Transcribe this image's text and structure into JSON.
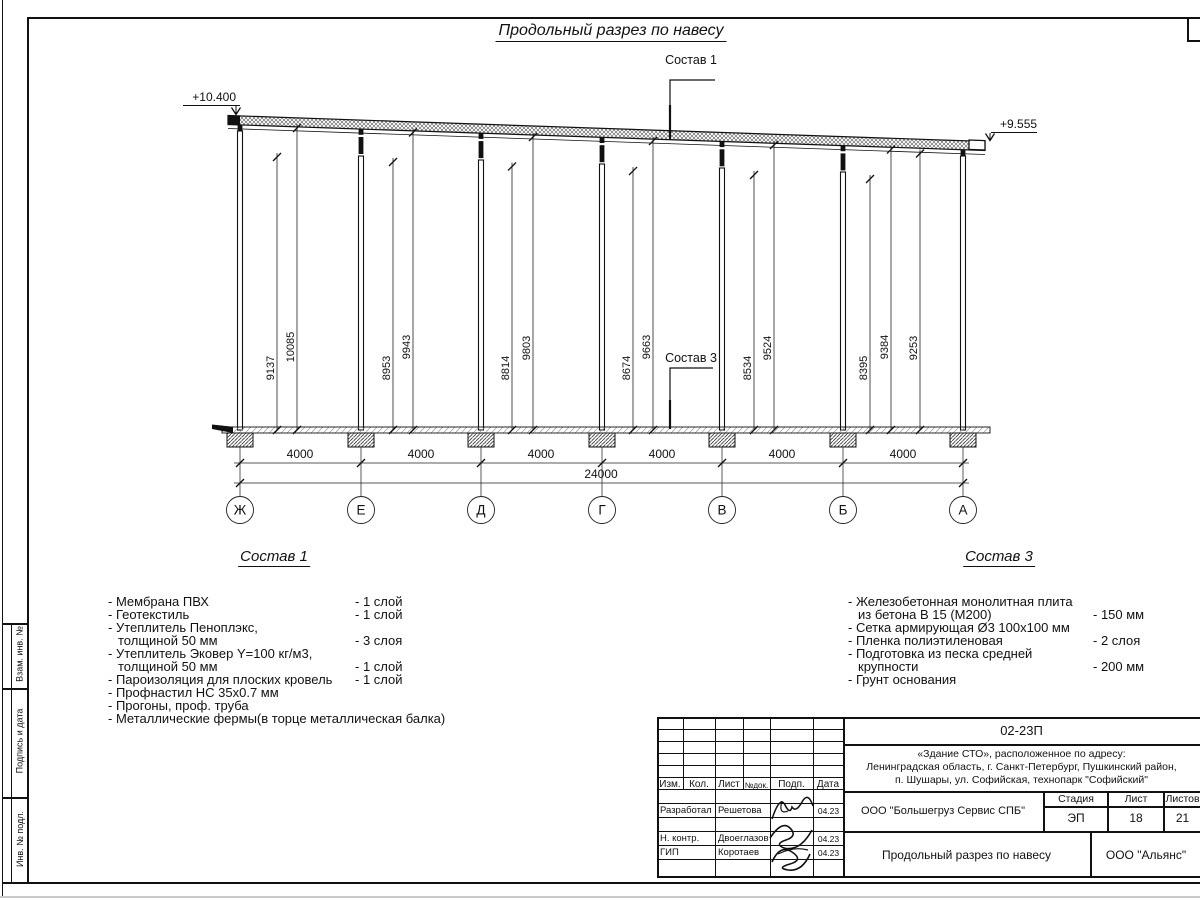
{
  "drawing": {
    "title": "Продольный разрез по навесу",
    "elevation_left": "+10.400",
    "elevation_right": "+9.555",
    "leader1": "Состав 1",
    "leader3": "Состав 3",
    "axis_labels": [
      "Ж",
      "Е",
      "Д",
      "Г",
      "В",
      "Б",
      "А"
    ],
    "bay_dim": "4000",
    "total_dim": "24000",
    "height_dims": [
      "9137",
      "10085",
      "8953",
      "9943",
      "8814",
      "9803",
      "8674",
      "9663",
      "8534",
      "9524",
      "8395",
      "9384",
      "9253"
    ]
  },
  "composition1": {
    "heading": "Состав 1",
    "lines": [
      {
        "left": "- Мембрана ПВХ",
        "right": "- 1 слой"
      },
      {
        "left": "- Геотекстиль",
        "right": "- 1 слой"
      },
      {
        "left": "- Утеплитель Пеноплэкс,",
        "right": ""
      },
      {
        "left": "толщиной 50 мм",
        "right": "- 3 слоя"
      },
      {
        "left": "- Утеплитель Эковер Y=100 кг/м3,",
        "right": ""
      },
      {
        "left": "толщиной 50 мм",
        "right": "- 1 слой"
      },
      {
        "left": "- Пароизоляция для плоских кровель",
        "right": "- 1 слой"
      },
      {
        "left": "- Профнастил НС 35х0.7 мм",
        "right": ""
      },
      {
        "left": "- Прогоны, проф. труба",
        "right": ""
      },
      {
        "left": "- Металлические фермы(в торце металлическая балка)",
        "right": ""
      }
    ]
  },
  "composition3": {
    "heading": "Состав 3",
    "lines": [
      {
        "left": "- Железобетонная  монолитная плита",
        "right": ""
      },
      {
        "left": "из бетона В 15 (М200)",
        "right": "- 150 мм"
      },
      {
        "left": "- Сетка армирующая Ø3 100х100 мм",
        "right": ""
      },
      {
        "left": "- Пленка полиэтиленовая",
        "right": "-  2 слоя"
      },
      {
        "left": "- Подготовка из песка средней",
        "right": ""
      },
      {
        "left": "крупности",
        "right": "- 200 мм"
      },
      {
        "left": "- Грунт основания",
        "right": ""
      }
    ]
  },
  "stamp": {
    "doc_code": "02-23П",
    "object_line1": "«Здание СТО», расположенное по адресу:",
    "object_line2": "Ленинградская область, г. Санкт-Петербург, Пушкинский район,",
    "object_line3": "п. Шушары, ул. Софийская, технопарк \"Софийский\"",
    "org": "ООО \"Большегруз Сервис СПБ\"",
    "stage_label": "Стадия",
    "sheet_label": "Лист",
    "sheets_label": "Листов",
    "stage": "ЭП",
    "sheet_no": "18",
    "sheets_total": "21",
    "drawing_name": "Продольный разрез по навесу",
    "company": "ООО \"Альянс\"",
    "rev_headers": [
      "Изм.",
      "Кол.",
      "Лист",
      "№док.",
      "Подп.",
      "Дата"
    ],
    "signers": [
      {
        "role": "Разработал",
        "name": "Решетова",
        "date": "04.23"
      },
      {
        "role": "Н. контр.",
        "name": "Двоеглазов",
        "date": "04.23"
      },
      {
        "role": "ГИП",
        "name": "Коротаев",
        "date": "04.23"
      }
    ]
  },
  "margin": {
    "labels": [
      "Взам. инв. №",
      "Подпись и дата",
      "Инв. № подл."
    ]
  }
}
